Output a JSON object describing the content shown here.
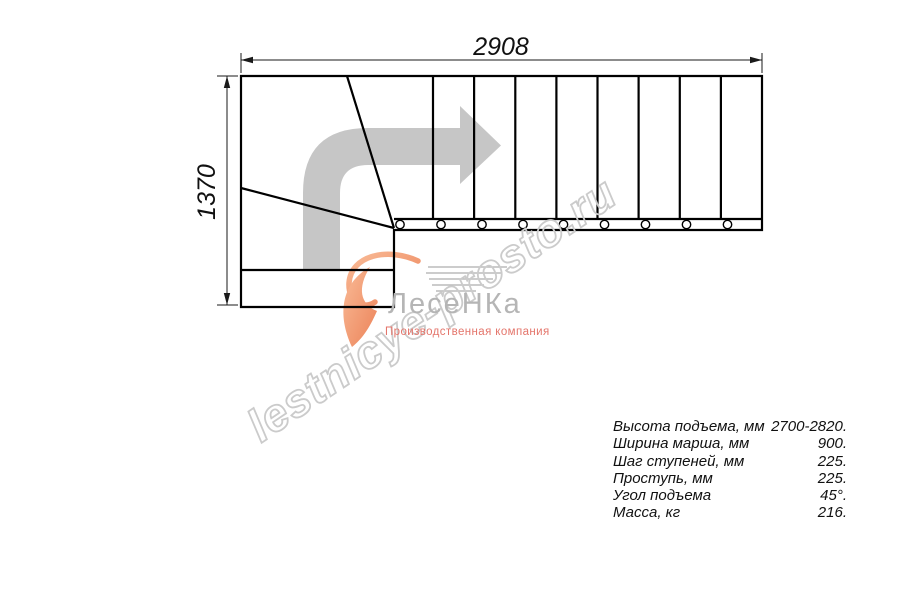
{
  "drawing": {
    "width_dim": "2908",
    "height_dim": "1370"
  },
  "watermark": {
    "text": "lestnicye-prosto.ru"
  },
  "logo": {
    "name": "ЛесеНКа",
    "tagline": "Производственная компания"
  },
  "specs": {
    "rows": [
      {
        "label": "Высота подъема, мм",
        "value": "2700-2820."
      },
      {
        "label": "Ширина марша, мм",
        "value": "900."
      },
      {
        "label": "Шаг ступеней, мм",
        "value": "225."
      },
      {
        "label": "Проступь, мм",
        "value": "225."
      },
      {
        "label": "Угол подъема",
        "value": "45°."
      },
      {
        "label": "Масса, кг",
        "value": "216."
      }
    ]
  },
  "colors": {
    "line": "#000000",
    "dimension": "#1a1a1a",
    "direction_arrow": "#c6c6c6",
    "watermark": "#cbcbcb",
    "logo_gray": "#b5b5b5",
    "logo_accent": "#e4756b",
    "swoosh_light": "#f9bb97",
    "swoosh_dark": "#ec8258"
  }
}
